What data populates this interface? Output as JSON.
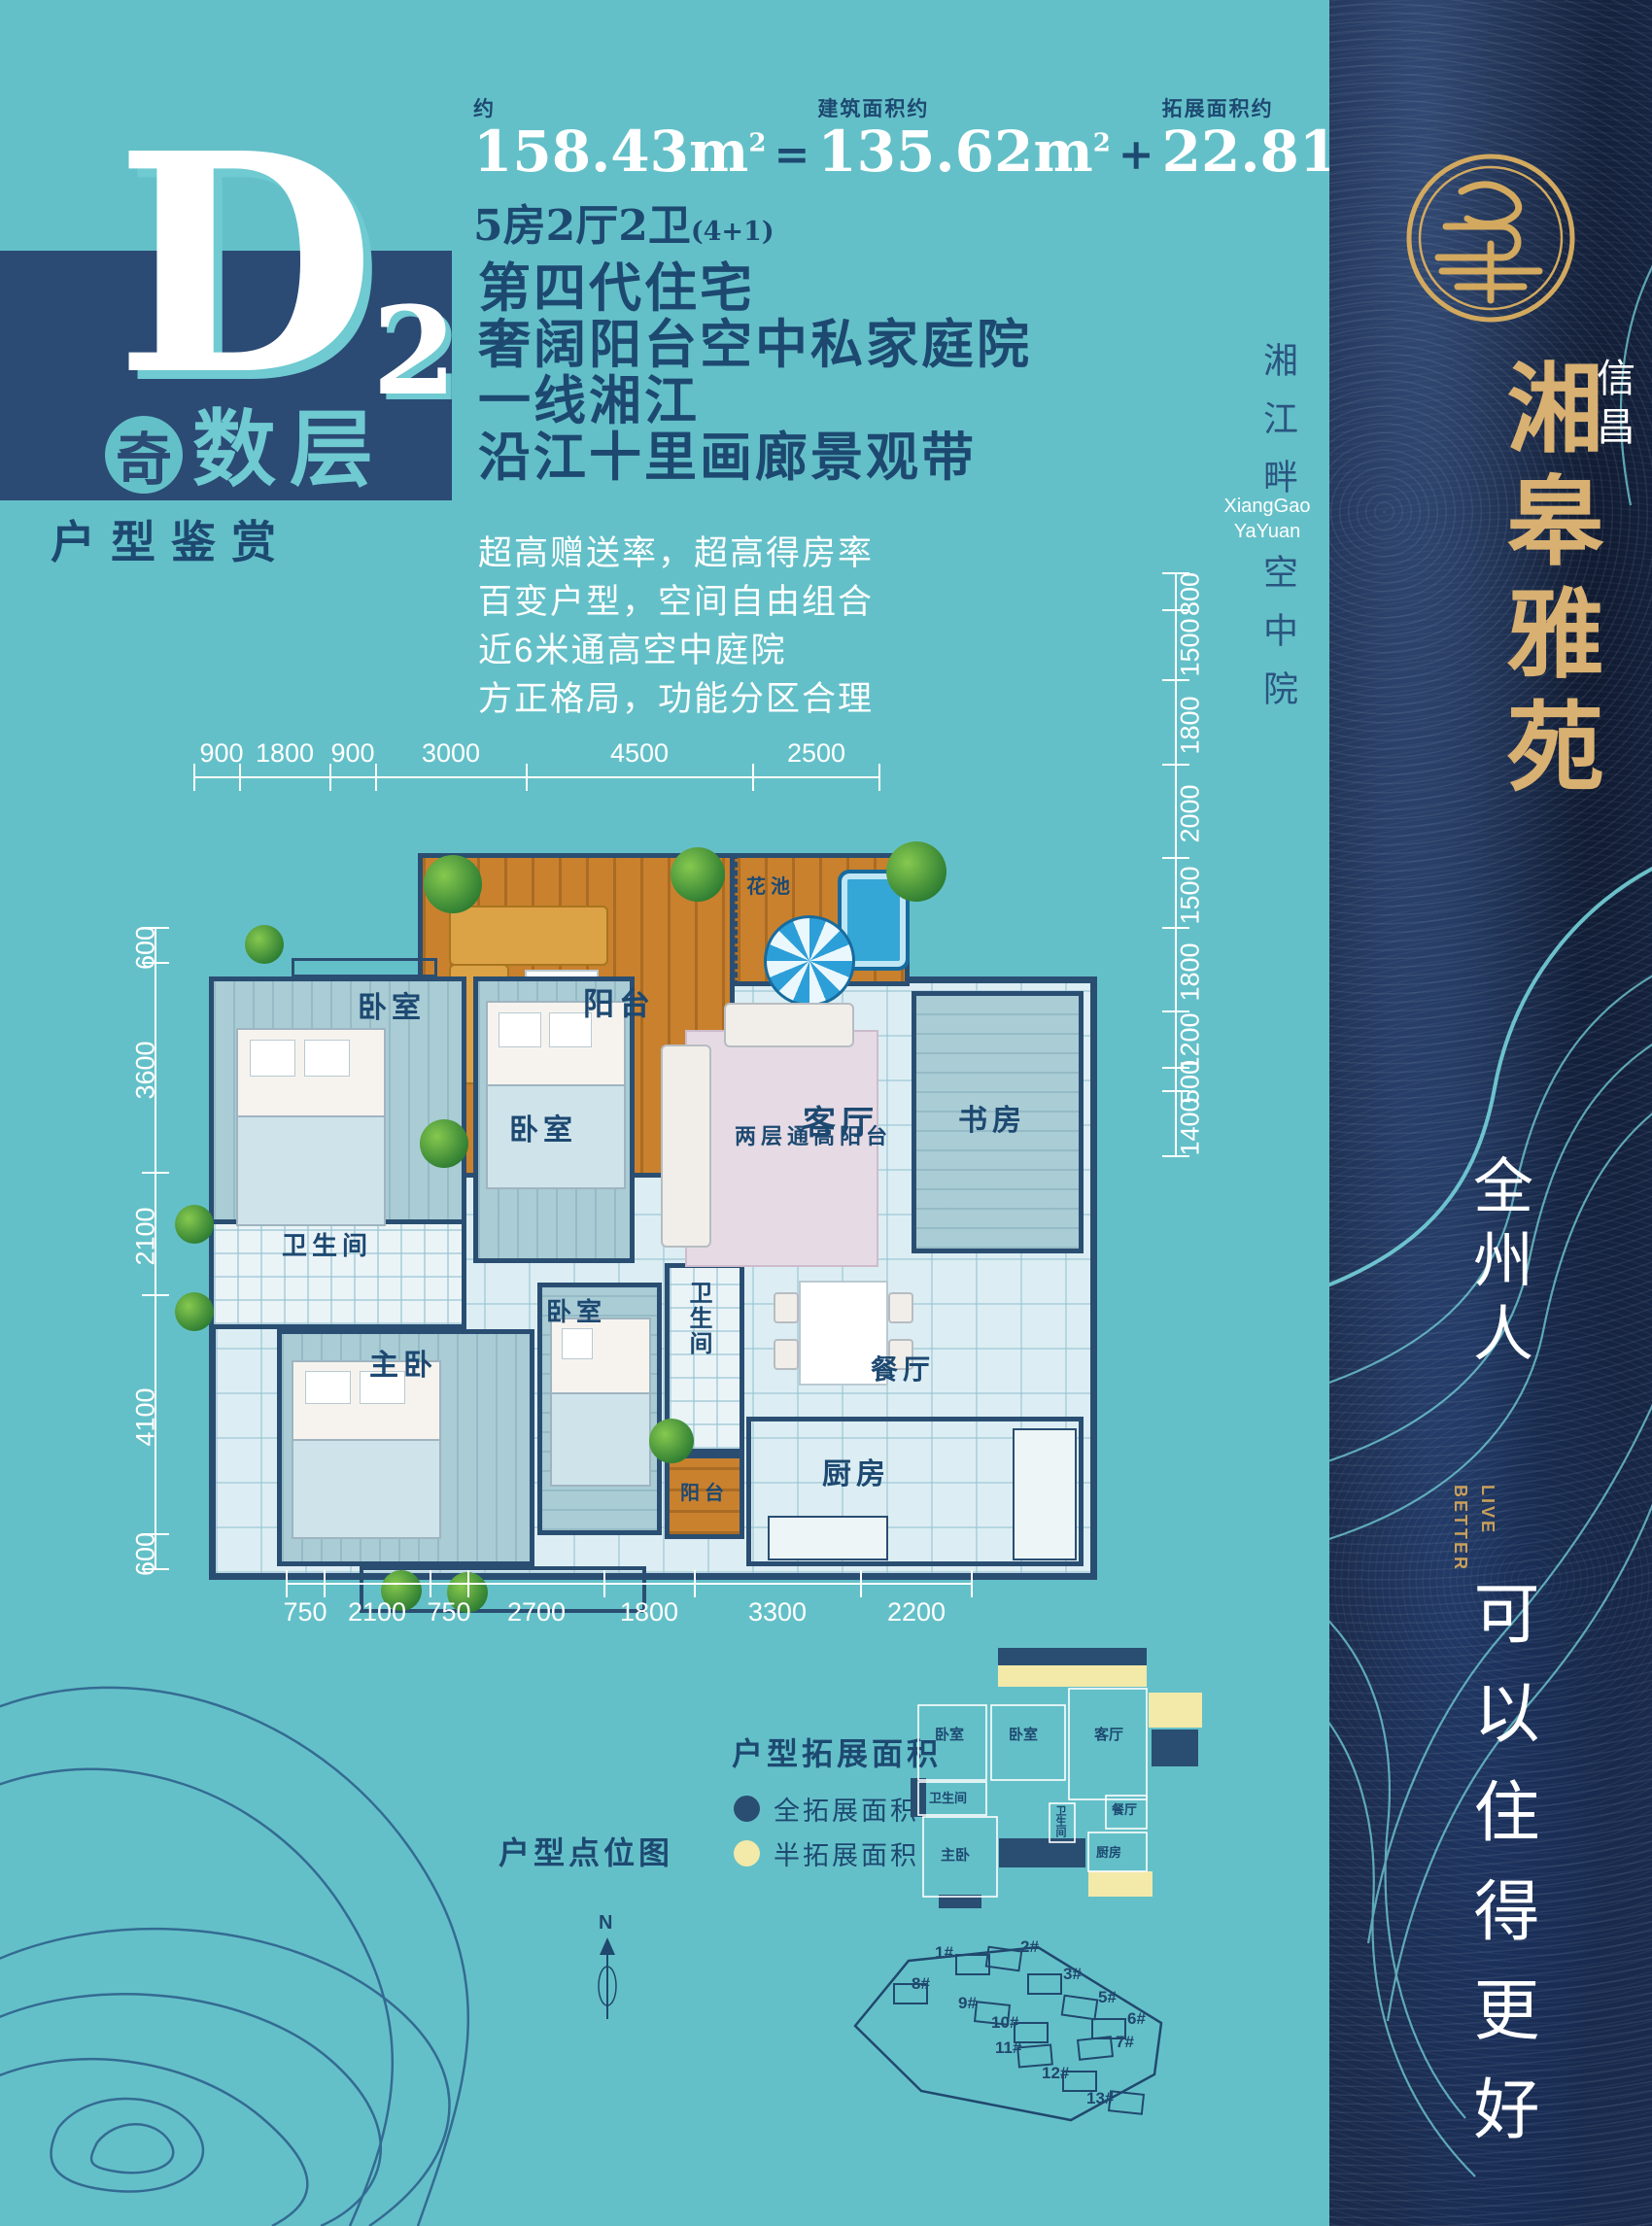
{
  "palette": {
    "teal_bg": "#64c0c8",
    "navy": "#2a4e72",
    "text_navy": "#1d4971",
    "gold": "#d8b071",
    "sidebar_bg": "#1b2b4c",
    "full_expand_color": "#2a4e72",
    "half_expand_color": "#f3e9a9"
  },
  "header": {
    "approx_label": "约",
    "total_area": "158.43",
    "unit": "m",
    "unit_sup": "2",
    "equals": "=",
    "built_label": "建筑面积约",
    "built_area": "135.62",
    "plus": "+",
    "expand_label": "拓展面积约",
    "expand_area": "22.81",
    "rooms_line": "5房2厅2卫",
    "rooms_suffix": "(4+1)"
  },
  "badge": {
    "letter": "D",
    "number": "2",
    "odd_char": "奇",
    "floor_label": "数层",
    "subtitle": "户型鉴赏"
  },
  "headlines": [
    "第四代住宅",
    "奢阔阳台空中私家庭院",
    "一线湘江",
    "沿江十里画廊景观带"
  ],
  "features": [
    "超高赠送率，超高得房率",
    "百变户型，空间自由组合",
    "近6米通高空中庭院",
    "方正格局，功能分区合理"
  ],
  "floorplan": {
    "dims_top": [
      "900",
      "1800",
      "900",
      "3000",
      "4500",
      "2500"
    ],
    "dims_bottom": [
      "750",
      "2100",
      "750",
      "2700",
      "1800",
      "3300",
      "2200"
    ],
    "dims_left": [
      "600",
      "3600",
      "2100",
      "4100",
      "600"
    ],
    "dims_right": [
      "800",
      "1500",
      "1800",
      "2000",
      "1500",
      "1800",
      "1200",
      "500",
      "1400"
    ],
    "rooms": {
      "balcony": "阳台",
      "flower_bed": "花池",
      "double_balcony": "两层通高阳台",
      "bedroom1": "卧室",
      "bedroom2": "卧室",
      "living": "客厅",
      "study": "书房",
      "bath1": "卫生间",
      "master": "主卧",
      "bedroom3": "卧室",
      "bath2": "卫生间",
      "small_balcony": "阳台",
      "dining": "餐厅",
      "kitchen": "厨房"
    }
  },
  "expansion": {
    "title": "户型拓展面积",
    "legend": [
      {
        "label": "全拓展面积",
        "color": "#2a4e72"
      },
      {
        "label": "半拓展面积",
        "color": "#f3e9a9"
      }
    ],
    "diagram": {
      "flower_bed": "花池",
      "balcony": "阳台",
      "double_balcony": "两层通高阳台",
      "balcony_right": "阳台",
      "study": "书房",
      "bedroom1": "卧室",
      "bedroom2": "卧室",
      "living": "客厅",
      "bath1": "卫生间",
      "master": "主卧",
      "equipment": "设备平台",
      "bath2": "卫生间",
      "dining": "餐厅",
      "kitchen": "厨房",
      "balcony_bottom": "阳台"
    }
  },
  "siteplan": {
    "title": "户型点位图",
    "north": "N",
    "buildings": [
      "1#",
      "2#",
      "3#",
      "5#",
      "6#",
      "7#",
      "8#",
      "9#",
      "10#",
      "11#",
      "12#",
      "13#"
    ]
  },
  "strip": {
    "line1": "湘江畔",
    "en1": "XiangGao",
    "en2": "YaYuan",
    "line2": "空中院"
  },
  "sidebar": {
    "brand_prefix": "信昌",
    "brand": "湘皋雅苑",
    "slogan_cn": "全州人",
    "slogan_en_1": "LIVE",
    "slogan_en_2": "BETTER",
    "slogan_cn2": "可以住得更好"
  }
}
